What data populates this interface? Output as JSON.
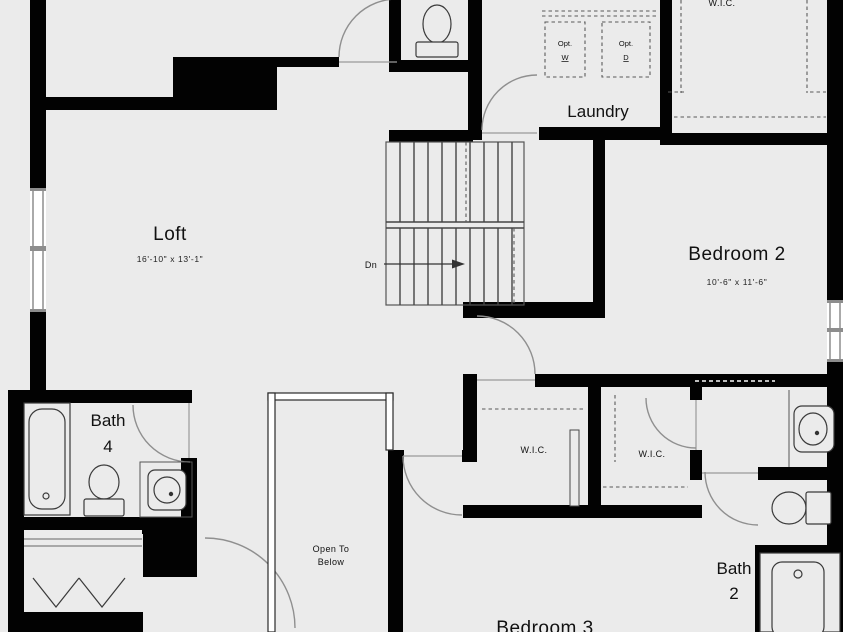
{
  "colors": {
    "background": "#ebebeb",
    "wall": "#020202",
    "line": "#3a3a3a",
    "door_arc": "#8f8f8f"
  },
  "rooms": {
    "loft": {
      "label": "Loft",
      "dimensions": "16'-10\" x 13'-1\""
    },
    "laundry": {
      "label": "Laundry"
    },
    "bedroom2": {
      "label": "Bedroom 2",
      "dimensions": "10'-6\" x 11'-6\""
    },
    "bedroom3": {
      "label": "Bedroom 3"
    },
    "bath4": {
      "label_line1": "Bath",
      "label_line2": "4"
    },
    "bath2": {
      "label_line1": "Bath",
      "label_line2": "2"
    },
    "wic_top": {
      "label": "W.I.C."
    },
    "wic_left": {
      "label": "W.I.C."
    },
    "wic_right": {
      "label": "W.I.C."
    }
  },
  "annotations": {
    "stair_direction": "Dn",
    "open_to_below": {
      "line1": "Open To",
      "line2": "Below"
    },
    "optional_washer": {
      "line1": "Opt.",
      "line2": "W"
    },
    "optional_dryer": {
      "line1": "Opt.",
      "line2": "D"
    }
  }
}
